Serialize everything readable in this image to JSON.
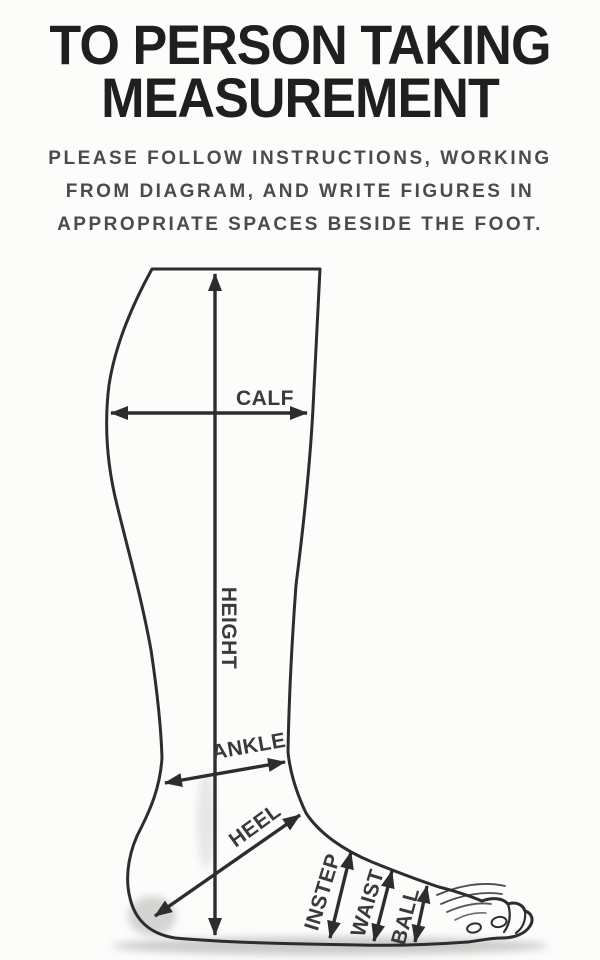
{
  "header": {
    "title_line1": "TO PERSON TAKING",
    "title_line2": "MEASUREMENT",
    "subtitle_lines": [
      "PLEASE FOLLOW INSTRUCTIONS, WORKING",
      "FROM DIAGRAM, AND WRITE FIGURES IN",
      "APPROPRIATE SPACES BESIDE THE FOOT."
    ]
  },
  "diagram": {
    "measurement_labels": {
      "calf": "CALF",
      "height": "HEIGHT",
      "ankle": "ANKLE",
      "heel": "HEEL",
      "instep": "INSTEP",
      "waist": "WAIST",
      "ball": "BALL"
    },
    "colors": {
      "ink": "#2d2d2d",
      "label_text": "#3a3a3a",
      "shadow": "#c6c6c4",
      "background": "#fcfcfb"
    }
  }
}
